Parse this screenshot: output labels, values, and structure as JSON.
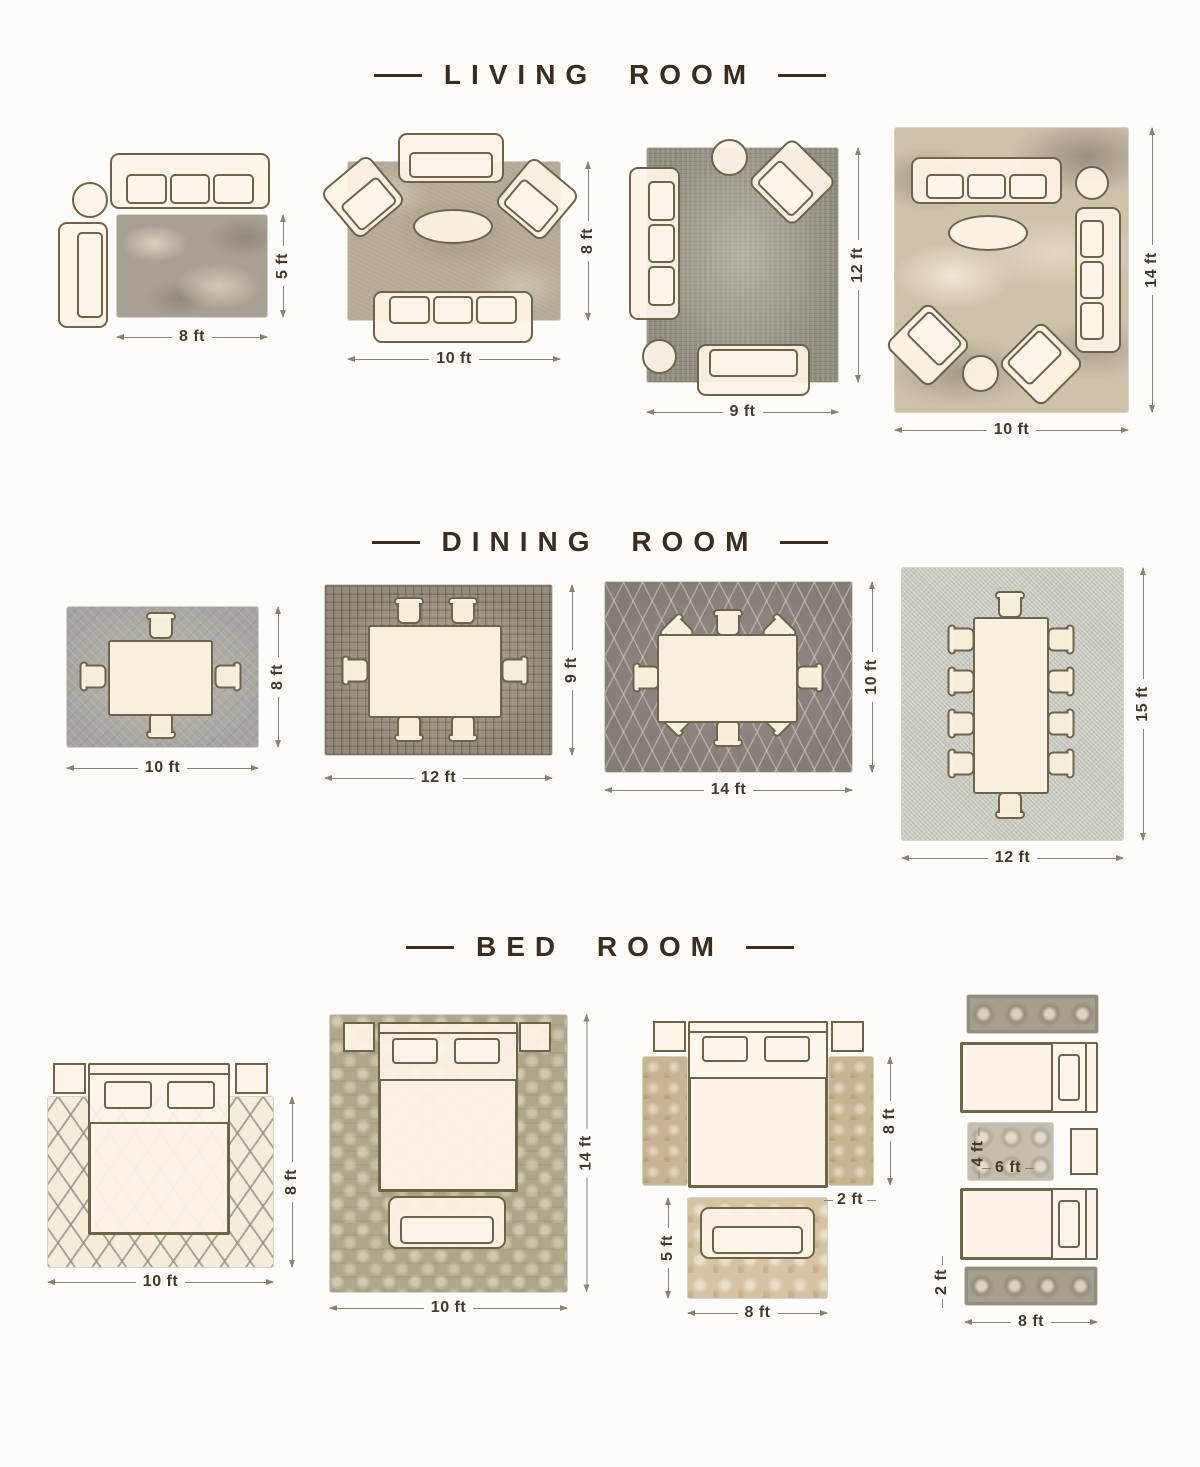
{
  "colors": {
    "background": "#fdfcf9",
    "title_ink": "#3a2d20",
    "furniture_outline": "#6f6349",
    "furniture_fill": "#fdf4e8",
    "dimension_text": "#44392b",
    "dimension_line": "#8b8273"
  },
  "sections": [
    {
      "title": "LIVING ROOM",
      "layouts": [
        {
          "name": "sofa-loveseat-rug",
          "width": "8 ft",
          "height": "5 ft"
        },
        {
          "name": "sofa-two-armchairs-rug",
          "width": "10 ft",
          "height": "8 ft"
        },
        {
          "name": "sofa-loveseat-armchair-rug",
          "width": "9 ft",
          "height": "12 ft"
        },
        {
          "name": "two-sofas-two-armchairs-rug",
          "width": "10 ft",
          "height": "14 ft"
        }
      ]
    },
    {
      "title": "DINING ROOM",
      "layouts": [
        {
          "name": "table-4-chairs-rug",
          "width": "10 ft",
          "height": "8 ft"
        },
        {
          "name": "table-6-chairs-rug",
          "width": "12 ft",
          "height": "9 ft"
        },
        {
          "name": "oval-table-8-chairs-rug",
          "width": "14 ft",
          "height": "10 ft"
        },
        {
          "name": "table-10-chairs-rug",
          "width": "12 ft",
          "height": "15 ft"
        }
      ]
    },
    {
      "title": "BED ROOM",
      "layouts": [
        {
          "name": "bed-on-full-rug",
          "width": "10 ft",
          "height": "8 ft"
        },
        {
          "name": "bed-bench-on-full-rug",
          "width": "10 ft",
          "height": "14 ft"
        },
        {
          "name": "bedside-runners-foot-rug",
          "runner_height": "8 ft",
          "runner_width": "2 ft",
          "foot_rug_height": "5 ft",
          "foot_rug_width": "8 ft"
        },
        {
          "name": "twin-beds-runners",
          "between_rug_height": "4 ft",
          "between_rug_width": "6 ft",
          "runner_height": "2 ft",
          "runner_width": "8 ft"
        }
      ]
    }
  ]
}
